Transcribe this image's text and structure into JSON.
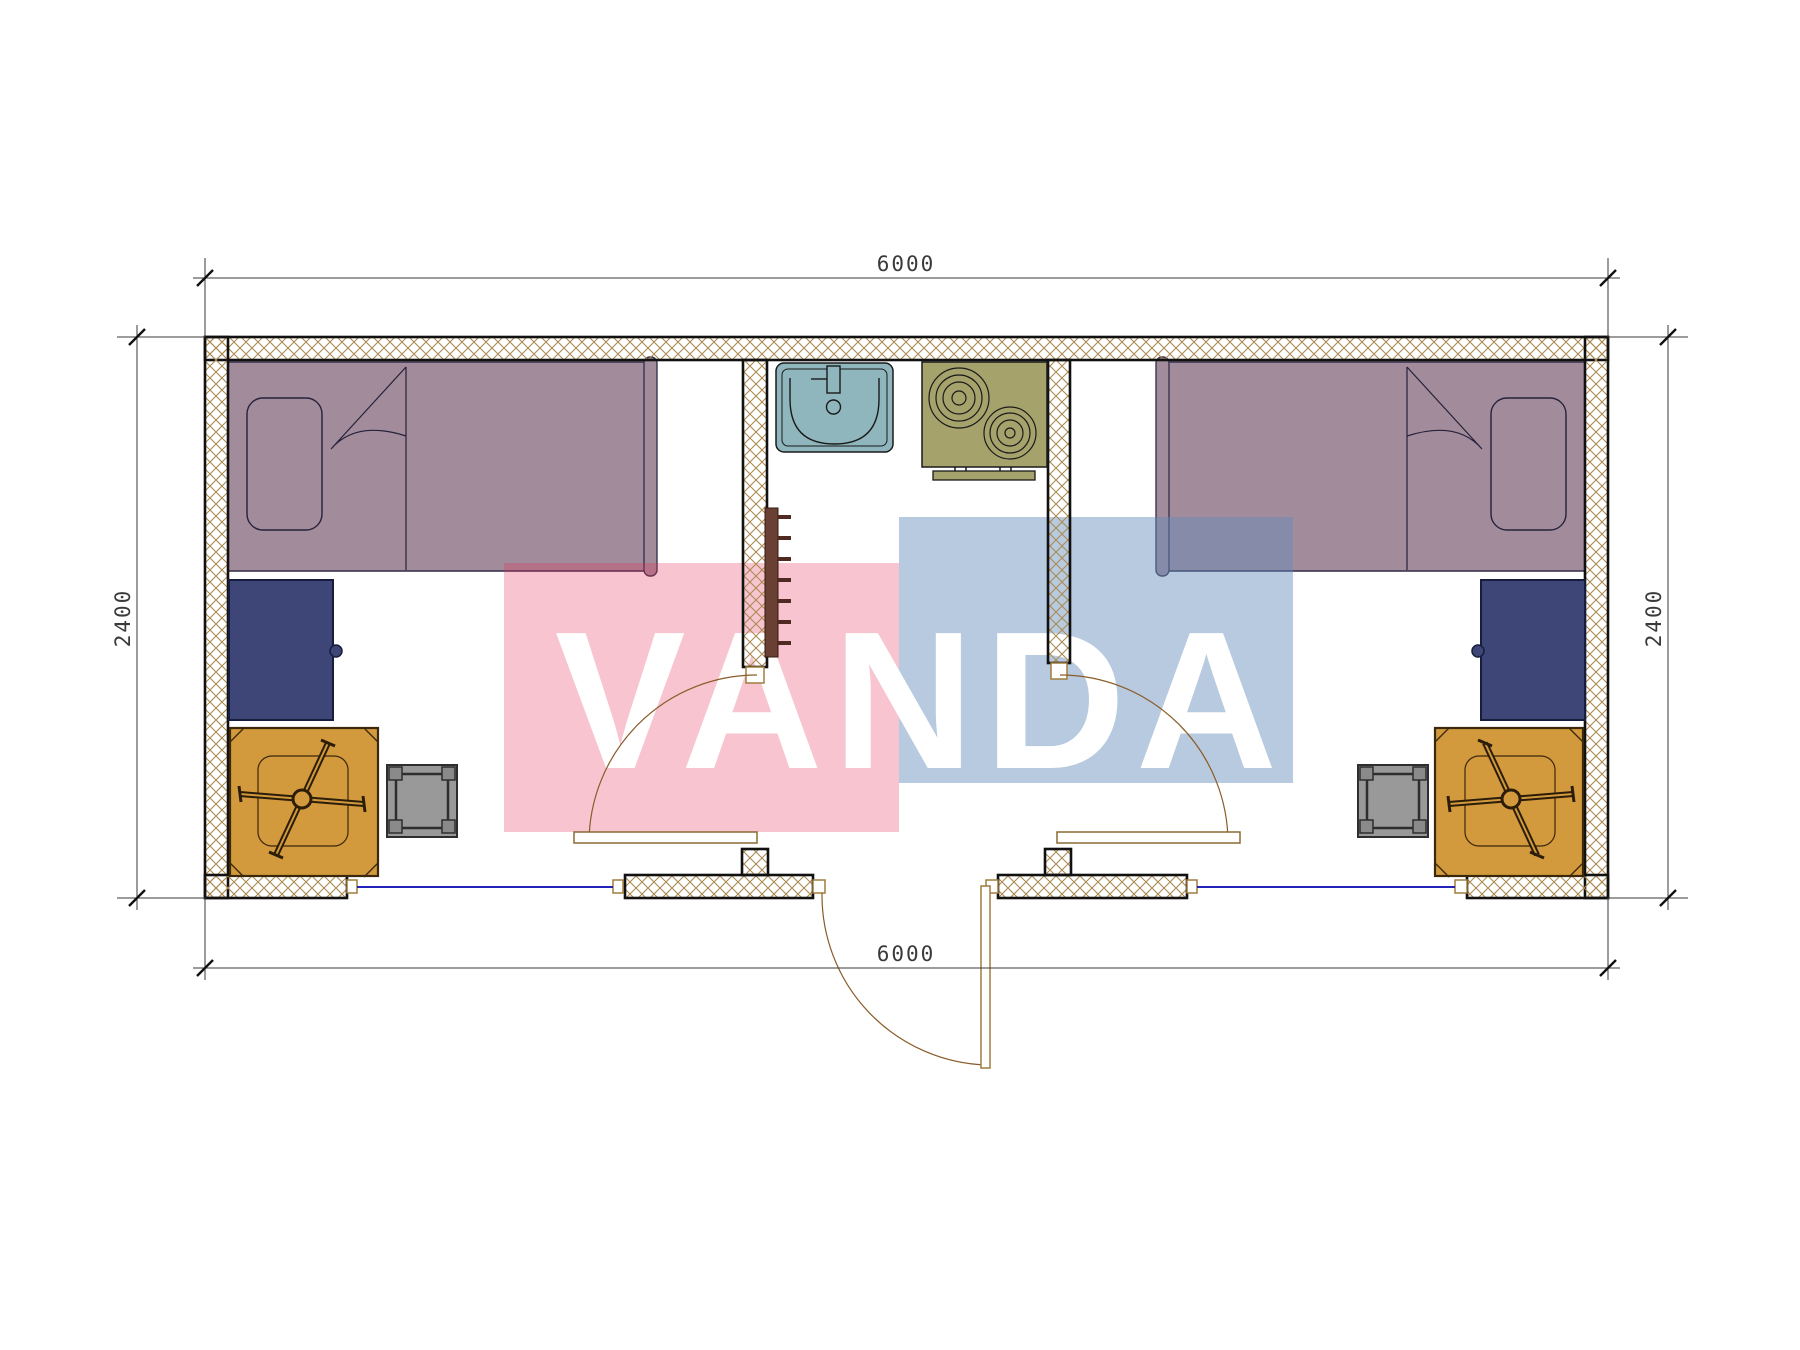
{
  "plan": {
    "dimensions": {
      "top": "6000",
      "bottom": "6000",
      "left": "2400",
      "right": "2400"
    },
    "watermark": {
      "text": "VANDA",
      "pink": "rgba(227,43,82,0.28)",
      "blue": "rgba(98,138,185,0.45)",
      "text_color": "#ffffff"
    },
    "colors": {
      "bed": "#a28c9b",
      "desk": "#3e4677",
      "table": "#d2993d",
      "stool": "#999999",
      "stool_corner": "#8a8a8a",
      "sink": "#8fb5bd",
      "stove": "#a5a26c",
      "radiator": "#6b4034",
      "wall_hatch": "#ab8a52",
      "window": "#2323bb",
      "door_arc": "#8a5c28",
      "dimension": "#3a3a3a"
    }
  }
}
